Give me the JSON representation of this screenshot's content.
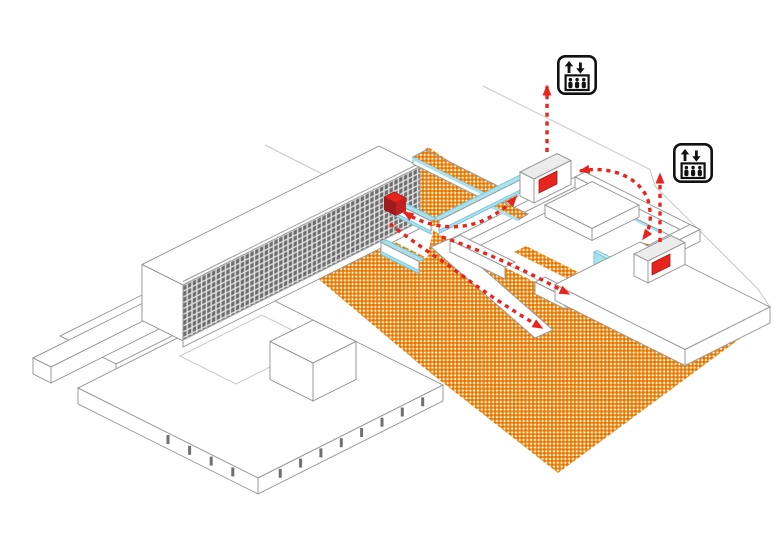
{
  "window": {
    "width": 780,
    "height": 541,
    "background": "#ffffff"
  },
  "scene": {
    "type": "axonometric-architecture-circulation-diagram",
    "description_labels": {
      "tower": "slab tower with gridded facade",
      "podium": "podium with roof box",
      "courtyard": "courtyard building",
      "circulation": "red dashed circulation route",
      "ground": "hatched public ground"
    }
  },
  "icons": {
    "elevator_1": {
      "label": "elevator"
    },
    "elevator_2": {
      "label": "elevator"
    }
  },
  "colors": {
    "outline": "#9a9a9a",
    "outline-dark": "#707070",
    "faint": "#c7c7c7",
    "orange": "#f5941f",
    "orange-dark": "#db7109",
    "cyan": "#a9e2ef",
    "cyan-dark": "#7bc8dc",
    "cyan-light": "#cdeef6",
    "red": "#e8251d",
    "red-dark": "#9e1c1b",
    "red-mid": "#c02220",
    "facade-bg": "#e4e4e4",
    "facade-window": "#6e6e6e",
    "pavilion-roof": "#ececec",
    "icon": "#111111",
    "floor-line": "#c0c0c0"
  }
}
